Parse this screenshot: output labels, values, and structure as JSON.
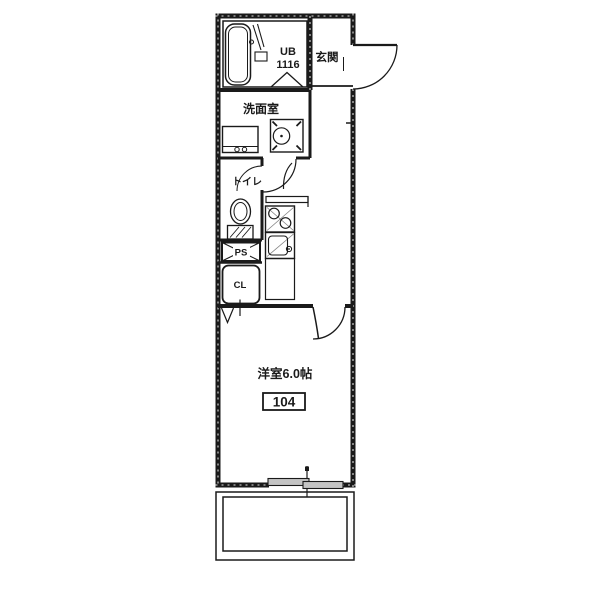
{
  "floor_plan": {
    "labels": {
      "unit_bath": "UB",
      "unit_bath_size": "1116",
      "entrance": "玄関",
      "washroom": "洗面室",
      "toilet": "トイレ",
      "pipe_space": "PS",
      "closet": "CL",
      "main_room": "洋室6.0帖",
      "room_number": "104"
    },
    "colors": {
      "line": "#1a1a1a",
      "window_fill": "#c4c4c4",
      "background": "#ffffff"
    }
  }
}
